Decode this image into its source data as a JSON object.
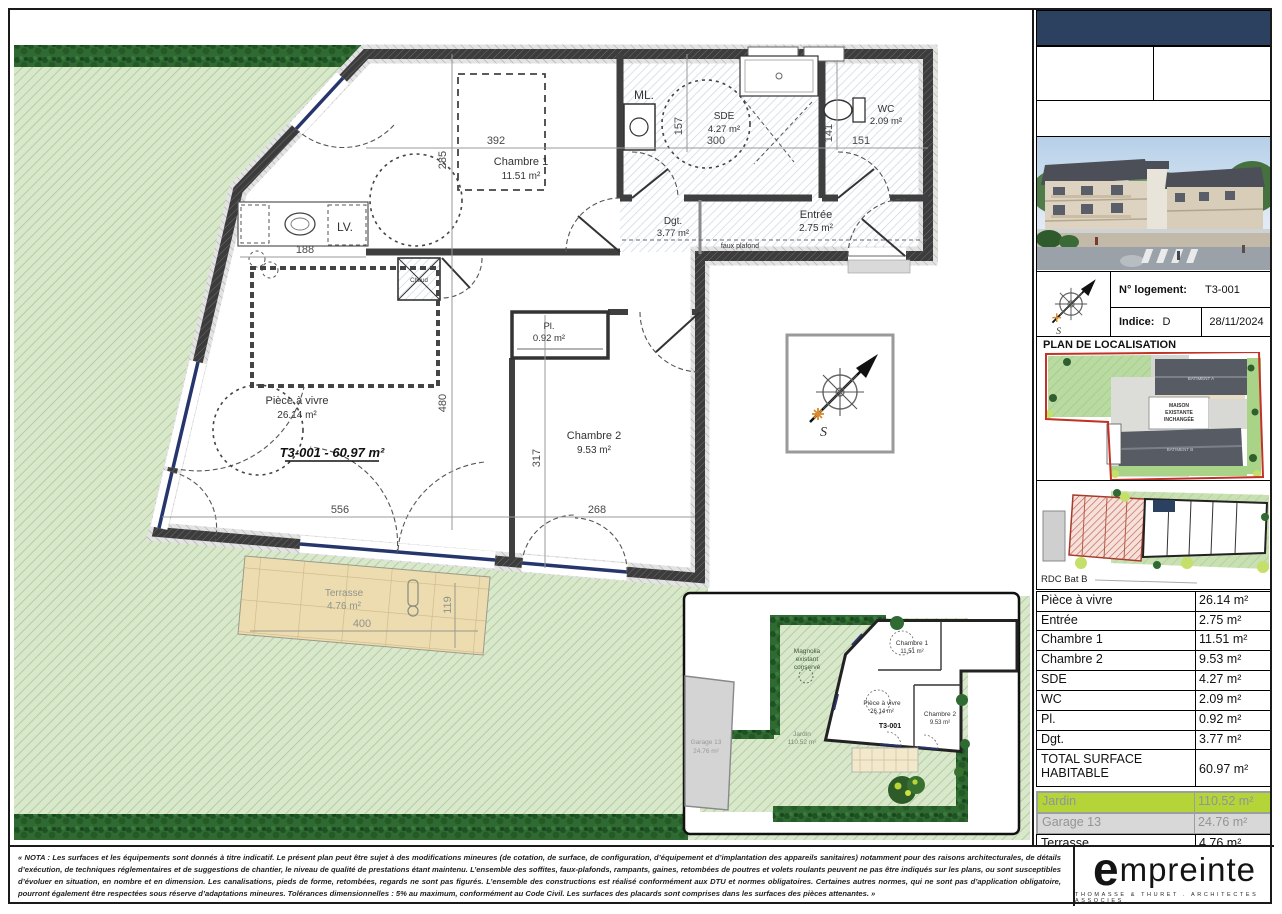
{
  "plan": {
    "unit_title": "T3-001 - 60.97 m²",
    "rooms": {
      "chambre1": {
        "name": "Chambre 1",
        "area": "11.51 m²"
      },
      "chambre2": {
        "name": "Chambre 2",
        "area": "9.53 m²"
      },
      "piece_a_vivre": {
        "name": "Pièce à vivre",
        "area": "26.14 m²"
      },
      "entree": {
        "name": "Entrée",
        "area": "2.75 m²"
      },
      "sde": {
        "name": "SDE",
        "area": "4.27 m²"
      },
      "wc": {
        "name": "WC",
        "area": "2.09 m²"
      },
      "pl": {
        "name": "Pl.",
        "area": "0.92 m²"
      },
      "dgt": {
        "name": "Dgt.",
        "area": "3.77 m²"
      },
      "terrasse": {
        "name": "Terrasse",
        "area": "4.76 m²"
      }
    },
    "annotations": {
      "ml": "ML.",
      "lv": "LV.",
      "chaud": "Chaud",
      "faux_plafond": "faux plafond",
      "south": "S"
    },
    "dimensions": {
      "w392": "392",
      "h285": "285",
      "h157": "157",
      "w300": "300",
      "h141": "141",
      "w151": "151",
      "w188": "188",
      "h480": "480",
      "h317": "317",
      "w268": "268",
      "w556": "556",
      "w400": "400",
      "h119": "119"
    }
  },
  "inset": {
    "magnolia_line1": "Magnolia",
    "magnolia_line2": "existant",
    "magnolia_line3": "conservé",
    "jardin_label": "Jardin",
    "jardin_area": "110.52 m²",
    "garage_label": "Garage 13",
    "garage_area": "24.76 m²",
    "unit": "T3-001"
  },
  "title_block": {
    "logement_label": "N° logement:",
    "logement_value": "T3-001",
    "indice_label": "Indice:",
    "indice_value": "D",
    "date": "28/11/2024",
    "localisation_title": "PLAN DE LOCALISATION",
    "maison_line1": "MAISON",
    "maison_line2": "EXISTANTE",
    "maison_line3": "INCHANGÉE",
    "batiment_a": "BATIMENT A",
    "batiment_b": "BATIMENT B",
    "key_plan_label": "RDC Bat B"
  },
  "surface_table": {
    "rows": [
      {
        "label": "Pièce à vivre",
        "value": "26.14 m²"
      },
      {
        "label": "Entrée",
        "value": "2.75 m²"
      },
      {
        "label": "Chambre 1",
        "value": "11.51 m²"
      },
      {
        "label": "Chambre 2",
        "value": "9.53 m²"
      },
      {
        "label": "SDE",
        "value": "4.27 m²"
      },
      {
        "label": "WC",
        "value": "2.09 m²"
      },
      {
        "label": "Pl.",
        "value": "0.92 m²"
      },
      {
        "label": "Dgt.",
        "value": "3.77 m²"
      }
    ],
    "total_label": "TOTAL SURFACE HABITABLE",
    "total_value": "60.97 m²",
    "jardin_label": "Jardin",
    "jardin_value": "110.52 m²",
    "garage_label": "Garage 13",
    "garage_value": "24.76 m²",
    "terrasse_label": "Terrasse",
    "terrasse_value": "4.76 m²"
  },
  "footer": {
    "nota": "« NOTA : Les surfaces et les équipements sont donnés à titre indicatif. Le présent plan peut être sujet à des modifications mineures (de cotation, de surface, de configuration, d’équipement et d’implantation des appareils sanitaires) notamment pour des raisons architecturales, de détails d’exécution, de techniques réglementaires et de suggestions de chantier, le niveau de qualité de prestations étant maintenu. L’ensemble des soffites, faux-plafonds, rampants, gaines, retombées de poutres et volets roulants peuvent ne pas être indiqués sur les plans, ou sont susceptibles d’évoluer en situation, en nombre et en dimension. Les canalisations, pieds de forme, retombées, regards ne sont pas figurés. L’ensemble des constructions est réalisé conformément aux DTU et normes obligatoires. Certaines autres normes, qui ne sont pas d’application obligatoire, pourront également être respectées sous réserve d’adaptations mineures. Tolérances dimensionnelles : 5% au maximum, conformément au Code Civil. Les surfaces des placards sont comprises dans les surfaces des pièces attenantes. »",
    "logo_text": "empreinte",
    "logo_subtitle": "THOMASSE & THURET . ARCHITECTES ASSOCIES"
  },
  "colors": {
    "accent_navy": "#2c4160",
    "jardin_highlight": "#b5d437",
    "garden_green": "#d9e8cb",
    "hedge_green": "#2e6a31",
    "boundary_red": "#c23226",
    "terrasse_beige": "#eddcb0",
    "window_blue": "#26356b"
  }
}
